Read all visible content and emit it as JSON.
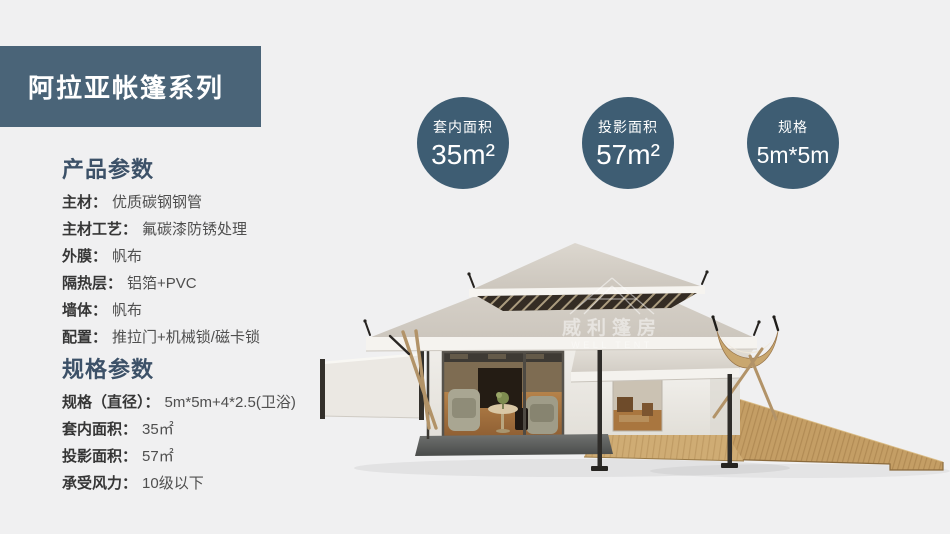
{
  "banner": {
    "title": "阿拉亚帐篷系列"
  },
  "badges": [
    {
      "label": "套内面积",
      "value": "35m²"
    },
    {
      "label": "投影面积",
      "value": "57m²"
    },
    {
      "label": "规格",
      "value": "5m*5m"
    }
  ],
  "sections": [
    {
      "heading": "产品参数",
      "rows": [
        {
          "label": "主材：",
          "value": "优质碳钢钢管"
        },
        {
          "label": "主材工艺：",
          "value": "氟碳漆防锈处理"
        },
        {
          "label": "外膜：",
          "value": "帆布"
        },
        {
          "label": "隔热层：",
          "value": "铝箔+PVC"
        },
        {
          "label": "墙体：",
          "value": "帆布"
        },
        {
          "label": "配置：",
          "value": "推拉门+机械锁/磁卡锁"
        }
      ]
    },
    {
      "heading": "规格参数",
      "rows": [
        {
          "label": "规格（直径）：",
          "value": "5m*5m+4*2.5(卫浴)"
        },
        {
          "label": "套内面积：",
          "value": "35㎡"
        },
        {
          "label": "投影面积：",
          "value": "57㎡"
        },
        {
          "label": "承受风力：",
          "value": "10级以下"
        }
      ]
    }
  ],
  "watermark": {
    "cn": "威利篷房",
    "en": "WELL TENT"
  },
  "colors": {
    "background": "#F0F0F1",
    "banner": "#4A6478",
    "badge": "#3E5D73",
    "heading": "#3C5168"
  }
}
